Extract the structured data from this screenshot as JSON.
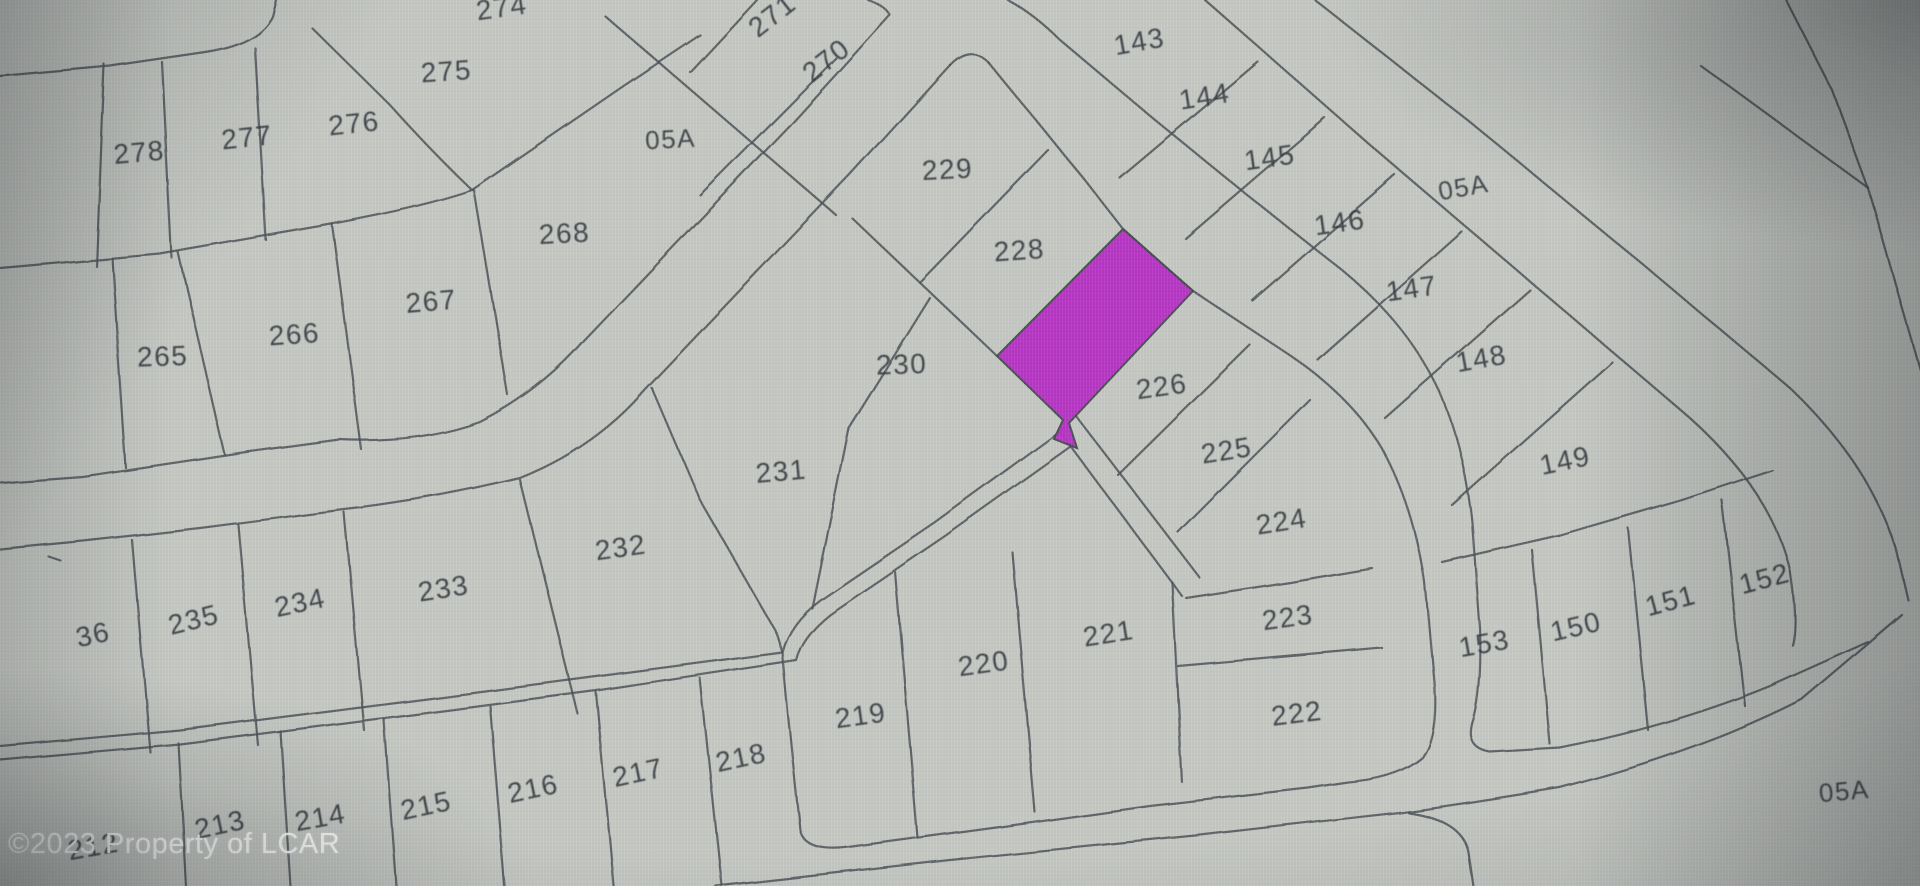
{
  "map": {
    "background_color": "#c7cac5",
    "line_color": "#4e5357",
    "label_color": "#383e43",
    "highlight_color": "#b832c6",
    "watermark": {
      "text": "©2023 Property of LCAR",
      "color": "#ffffff"
    },
    "highlight_parcel": {
      "description": "highlighted-lot-between-228-and-226",
      "points": "1123,229 1193,291 1069,423 1077,448 1054,439 1063,420 997,356"
    },
    "labels": [
      {
        "text": "274",
        "x": 503,
        "y": 6,
        "r": -8,
        "s": 28
      },
      {
        "text": "275",
        "x": 447,
        "y": 70,
        "r": -4,
        "s": 28
      },
      {
        "text": "276",
        "x": 355,
        "y": 122,
        "r": -6,
        "s": 28
      },
      {
        "text": "277",
        "x": 248,
        "y": 136,
        "r": -6,
        "s": 28
      },
      {
        "text": "278",
        "x": 140,
        "y": 151,
        "r": -5,
        "s": 28
      },
      {
        "text": "271",
        "x": 778,
        "y": 12,
        "r": -38,
        "s": 28
      },
      {
        "text": "270",
        "x": 832,
        "y": 57,
        "r": -38,
        "s": 28
      },
      {
        "text": "05A",
        "x": 671,
        "y": 138,
        "r": -3,
        "s": 26
      },
      {
        "text": "268",
        "x": 565,
        "y": 232,
        "r": -3,
        "s": 28
      },
      {
        "text": "267",
        "x": 432,
        "y": 300,
        "r": -5,
        "s": 28
      },
      {
        "text": "266",
        "x": 295,
        "y": 333,
        "r": -4,
        "s": 28
      },
      {
        "text": "265",
        "x": 163,
        "y": 355,
        "r": -2,
        "s": 28
      },
      {
        "text": "229",
        "x": 948,
        "y": 168,
        "r": -3,
        "s": 28
      },
      {
        "text": "228",
        "x": 1020,
        "y": 249,
        "r": -4,
        "s": 28
      },
      {
        "text": "230",
        "x": 902,
        "y": 363,
        "r": -2,
        "s": 28
      },
      {
        "text": "231",
        "x": 782,
        "y": 470,
        "r": -5,
        "s": 28
      },
      {
        "text": "232",
        "x": 622,
        "y": 546,
        "r": -8,
        "s": 28
      },
      {
        "text": "233",
        "x": 445,
        "y": 587,
        "r": -9,
        "s": 28
      },
      {
        "text": "234",
        "x": 302,
        "y": 601,
        "r": -12,
        "s": 28
      },
      {
        "text": "235",
        "x": 196,
        "y": 618,
        "r": -14,
        "s": 28
      },
      {
        "text": "36",
        "x": 95,
        "y": 633,
        "r": -12,
        "s": 28
      },
      {
        "text": "143",
        "x": 1141,
        "y": 40,
        "r": -10,
        "s": 28
      },
      {
        "text": "144",
        "x": 1206,
        "y": 95,
        "r": -9,
        "s": 28
      },
      {
        "text": "145",
        "x": 1271,
        "y": 156,
        "r": -8,
        "s": 28
      },
      {
        "text": "146",
        "x": 1341,
        "y": 221,
        "r": -8,
        "s": 28
      },
      {
        "text": "147",
        "x": 1413,
        "y": 287,
        "r": -8,
        "s": 28
      },
      {
        "text": "148",
        "x": 1483,
        "y": 357,
        "r": -10,
        "s": 28
      },
      {
        "text": "149",
        "x": 1567,
        "y": 459,
        "r": -12,
        "s": 28
      },
      {
        "text": "05A",
        "x": 1465,
        "y": 186,
        "r": -10,
        "s": 26
      },
      {
        "text": "226",
        "x": 1163,
        "y": 385,
        "r": -8,
        "s": 28
      },
      {
        "text": "225",
        "x": 1228,
        "y": 449,
        "r": -9,
        "s": 28
      },
      {
        "text": "224",
        "x": 1283,
        "y": 520,
        "r": -9,
        "s": 28
      },
      {
        "text": "223",
        "x": 1289,
        "y": 616,
        "r": -8,
        "s": 28
      },
      {
        "text": "222",
        "x": 1298,
        "y": 712,
        "r": -7,
        "s": 28
      },
      {
        "text": "221",
        "x": 1110,
        "y": 632,
        "r": -9,
        "s": 28
      },
      {
        "text": "220",
        "x": 985,
        "y": 662,
        "r": -8,
        "s": 28
      },
      {
        "text": "219",
        "x": 862,
        "y": 714,
        "r": -8,
        "s": 28
      },
      {
        "text": "218",
        "x": 743,
        "y": 756,
        "r": -12,
        "s": 28
      },
      {
        "text": "217",
        "x": 640,
        "y": 771,
        "r": -12,
        "s": 28
      },
      {
        "text": "216",
        "x": 535,
        "y": 787,
        "r": -12,
        "s": 28
      },
      {
        "text": "215",
        "x": 428,
        "y": 804,
        "r": -12,
        "s": 28
      },
      {
        "text": "214",
        "x": 322,
        "y": 816,
        "r": -10,
        "s": 28
      },
      {
        "text": "213",
        "x": 222,
        "y": 823,
        "r": -12,
        "s": 28
      },
      {
        "text": "212",
        "x": 95,
        "y": 845,
        "r": -10,
        "s": 28
      },
      {
        "text": "152",
        "x": 1767,
        "y": 577,
        "r": -15,
        "s": 28
      },
      {
        "text": "151",
        "x": 1673,
        "y": 599,
        "r": -15,
        "s": 28
      },
      {
        "text": "150",
        "x": 1578,
        "y": 625,
        "r": -13,
        "s": 28
      },
      {
        "text": "153",
        "x": 1486,
        "y": 642,
        "r": -10,
        "s": 28
      },
      {
        "text": "05A",
        "x": 1845,
        "y": 790,
        "r": -5,
        "s": 26
      }
    ],
    "boundaries": [
      "M 0 76 L 110 66 L 205 52 Q 258 44 272 16 L 276 0",
      "M 868 0 Q 885 6 890 15 L 790 125 L 685 235 L 585 340 Q 540 392 480 422 Q 420 444 340 440 L 250 452 L 83 477 L 0 483",
      "M 757 0 L 690 72",
      "M 836 58 L 700 195",
      "M 605 16 L 836 215",
      "M 0 268 L 160 254 L 320 226 Q 420 208 472 190",
      "M 472 190 L 625 85 L 700 35",
      "M 162 62 L 172 258",
      "M 255 48 L 266 240",
      "M 312 28 L 390 105 Q 432 152 472 190",
      "M 104 64 L 96 266",
      "M 178 252 L 225 455",
      "M 332 224 L 362 450",
      "M 474 190 L 508 395",
      "M 112 258 L 126 468",
      "M 950 65 Q 970 44 988 62",
      "M 950 65 L 850 175 L 745 285 L 645 390 Q 595 448 520 478 Q 430 500 340 510 L 200 528 L 83 541 L 0 549",
      "M 988 62 L 1085 180 L 1123 229 L 1193 291 L 1285 352 Q 1352 396 1384 452 Q 1414 508 1425 582 L 1434 682 Q 1438 735 1422 757 Q 1398 778 1348 782 L 1308 788 L 1150 806 L 1000 827 L 845 848 Q 805 852 800 830 L 788 715 L 782 652",
      "M 852 218 L 997 356",
      "M 1048 150 L 920 282",
      "M 930 298 L 848 430 L 812 608",
      "M 652 388 L 700 500 L 775 630 L 782 652",
      "M 520 480 L 578 714",
      "M 344 512 L 364 730",
      "M 238 525 L 258 745",
      "M 132 540 L 150 752",
      "M 1064 428 L 935 522 L 820 600 Q 790 622 782 652 L 600 676 L 400 702 L 180 730 L 0 746",
      "M 1074 444 L 945 536 L 830 614 Q 802 636 796 660 L 600 690 L 400 716 L 180 744 L 0 760",
      "M 1076 416 L 1200 578",
      "M 1060 432 L 1182 596",
      "M 1250 345 L 1118 475",
      "M 1310 400 L 1178 532",
      "M 1186 598 L 1290 582 L 1372 568",
      "M 1178 666 L 1382 648",
      "M 1172 582 L 1182 782",
      "M 1012 552 L 1035 812",
      "M 895 572 L 918 838",
      "M 700 678 L 722 886",
      "M 596 692 L 614 886",
      "M 490 706 L 505 886",
      "M 384 719 L 396 886",
      "M 280 731 L 290 886",
      "M 178 743 L 186 886",
      "M 1008 0 Q 1034 14 1060 40 L 1150 116 L 1246 194 L 1342 270 Q 1408 324 1440 392 Q 1464 448 1472 522 L 1480 628 Q 1482 695 1472 724 Q 1466 748 1490 752 L 1560 748 Q 1672 726 1770 686 L 1868 642",
      "M 1442 562 L 1560 535 L 1680 500 L 1772 470",
      "M 1532 550 L 1550 744",
      "M 1628 528 L 1648 730",
      "M 1722 500 L 1745 706",
      "M 1205 0 L 1370 145 L 1540 290 L 1690 418 Q 1772 492 1790 570 Q 1798 622 1792 645",
      "M 1315 0 L 1470 122 L 1640 262 L 1790 388 Q 1868 462 1896 548 L 1908 600",
      "M 716 886 L 950 860 L 1200 835 L 1395 813 Q 1450 806 1560 788 Q 1700 752 1802 700 L 1902 615",
      "M 1408 812 Q 1462 820 1468 852 L 1473 886",
      "M 1700 65 L 1868 188 L 1920 370",
      "M 1786 0 L 1832 90 L 1868 188",
      "M 1258 62 L 1120 178",
      "M 1325 118 L 1185 238",
      "M 1395 175 L 1252 300",
      "M 1462 232 L 1318 360",
      "M 1530 290 L 1385 418",
      "M 1612 362 L 1452 505",
      "M 48 556 L 60 560"
    ]
  }
}
